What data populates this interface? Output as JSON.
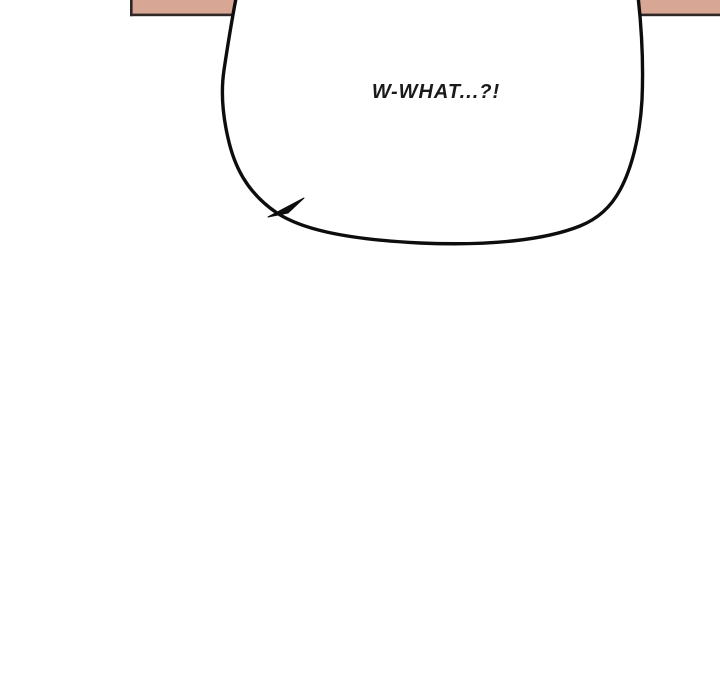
{
  "panel": {
    "background_color": "#ffffff",
    "wall_strip": {
      "fill_color": "#d8a694",
      "border_color": "#2f2726"
    },
    "speech_bubble": {
      "text": "W-WHAT...?!",
      "fill_color": "#ffffff",
      "outline_color": "#0d0d0d",
      "text_color": "#1a1a1a"
    }
  }
}
